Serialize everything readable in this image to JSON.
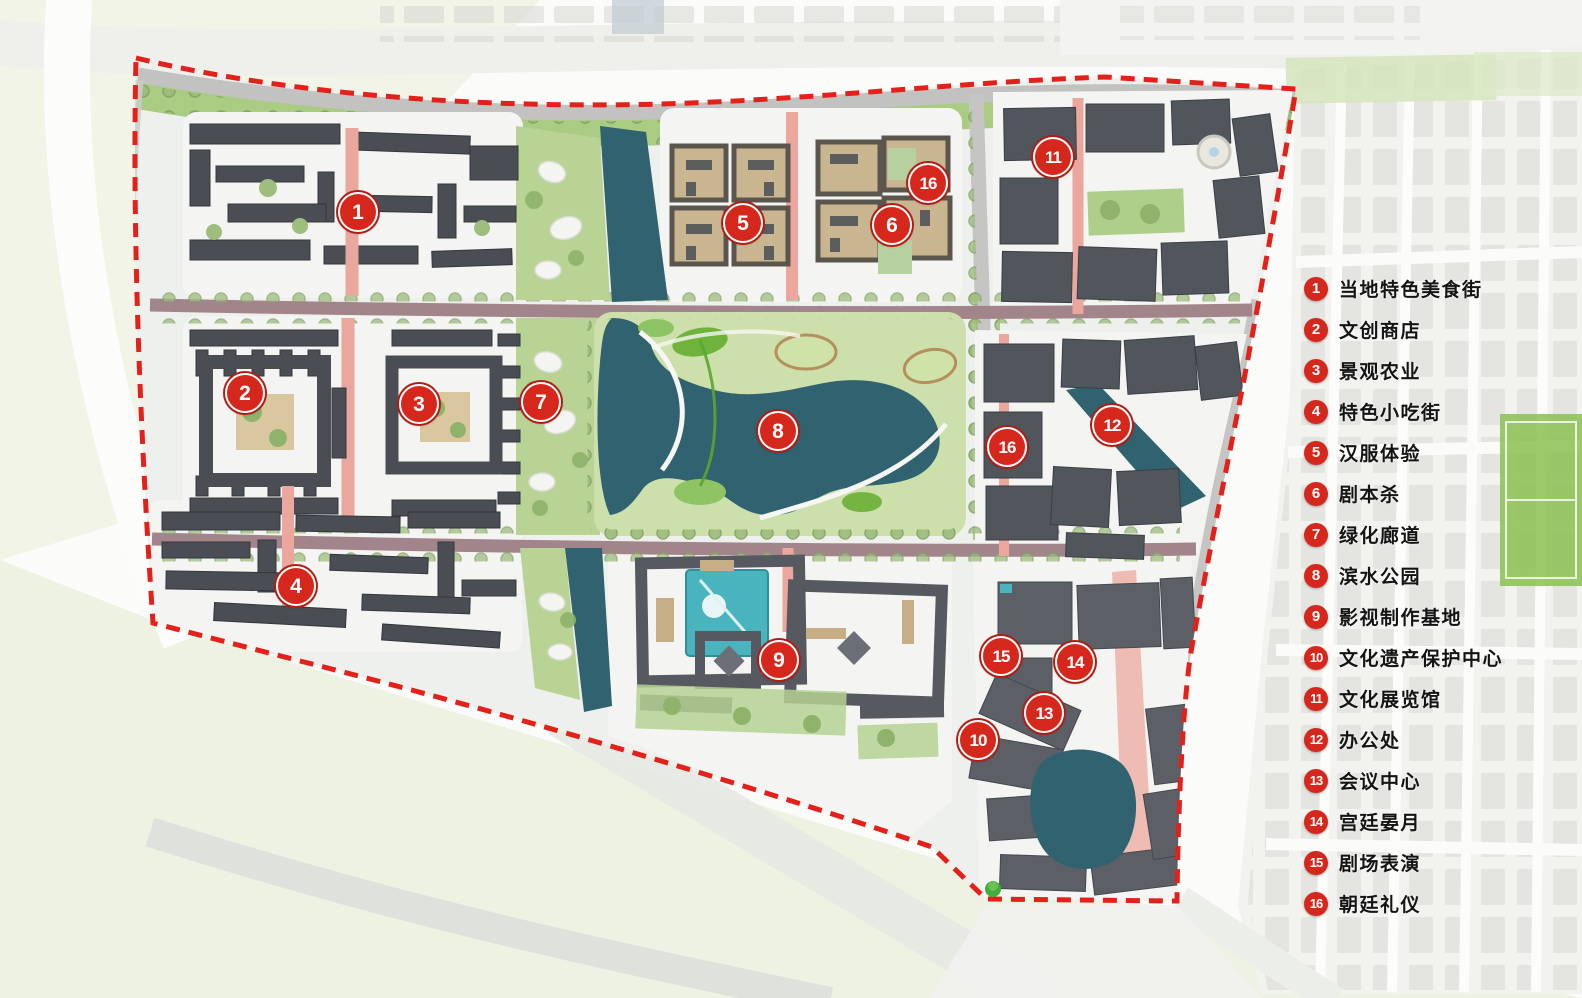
{
  "legend": {
    "items": [
      {
        "num": "1",
        "label": "当地特色美食街"
      },
      {
        "num": "2",
        "label": "文创商店"
      },
      {
        "num": "3",
        "label": "景观农业"
      },
      {
        "num": "4",
        "label": "特色小吃街"
      },
      {
        "num": "5",
        "label": "汉服体验"
      },
      {
        "num": "6",
        "label": "剧本杀"
      },
      {
        "num": "7",
        "label": "绿化廊道"
      },
      {
        "num": "8",
        "label": "滨水公园"
      },
      {
        "num": "9",
        "label": "影视制作基地"
      },
      {
        "num": "10",
        "label": "文化遗产保护中心"
      },
      {
        "num": "11",
        "label": "文化展览馆"
      },
      {
        "num": "12",
        "label": "办公处"
      },
      {
        "num": "13",
        "label": "会议中心"
      },
      {
        "num": "14",
        "label": "宫廷晏月"
      },
      {
        "num": "15",
        "label": "剧场表演"
      },
      {
        "num": "16",
        "label": "朝廷礼仪"
      }
    ]
  },
  "map_markers": [
    {
      "num": "1",
      "x": 358,
      "y": 212
    },
    {
      "num": "2",
      "x": 245,
      "y": 393
    },
    {
      "num": "3",
      "x": 419,
      "y": 404
    },
    {
      "num": "4",
      "x": 296,
      "y": 586
    },
    {
      "num": "5",
      "x": 743,
      "y": 223
    },
    {
      "num": "6",
      "x": 892,
      "y": 225
    },
    {
      "num": "7",
      "x": 541,
      "y": 402
    },
    {
      "num": "8",
      "x": 778,
      "y": 431
    },
    {
      "num": "9",
      "x": 779,
      "y": 660
    },
    {
      "num": "10",
      "x": 978,
      "y": 740
    },
    {
      "num": "11",
      "x": 1053,
      "y": 157
    },
    {
      "num": "12",
      "x": 1112,
      "y": 425
    },
    {
      "num": "13",
      "x": 1044,
      "y": 713
    },
    {
      "num": "14",
      "x": 1075,
      "y": 662
    },
    {
      "num": "15",
      "x": 1001,
      "y": 656
    },
    {
      "num": "16",
      "x": 928,
      "y": 183
    },
    {
      "num": "16",
      "x": 1007,
      "y": 447
    }
  ],
  "colors": {
    "boundary_red": "#e3211a",
    "marker_red": "#d6271d",
    "water": "#30626f",
    "legend_text": "#141414"
  }
}
